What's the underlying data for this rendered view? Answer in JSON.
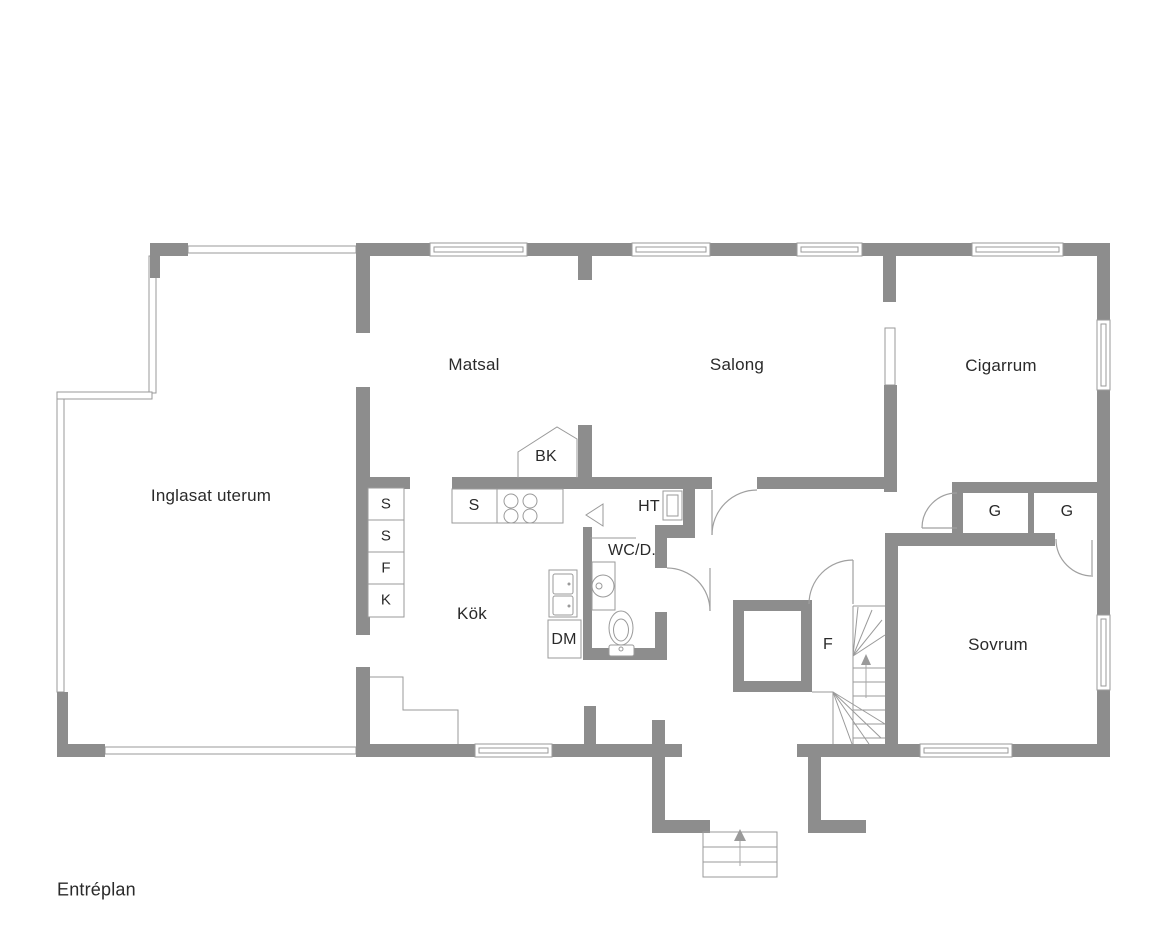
{
  "title": "Entréplan",
  "rooms": {
    "inglasat_uterum": "Inglasat uterum",
    "matsal": "Matsal",
    "salong": "Salong",
    "cigarrum": "Cigarrum",
    "kok": "Kök",
    "wc": "WC/D.",
    "sovrum": "Sovrum"
  },
  "labels": {
    "bk": "BK",
    "ht": "HT",
    "dm": "DM",
    "f": "F",
    "g_left": "G",
    "g_right": "G",
    "s_counter": "S",
    "cabinet_1": "S",
    "cabinet_2": "S",
    "cabinet_3": "F",
    "cabinet_4": "K"
  },
  "colors": {
    "wall": "#8d8d8d",
    "thin_line": "#9a9a9a",
    "text": "#2a2a2a",
    "background": "#ffffff"
  }
}
